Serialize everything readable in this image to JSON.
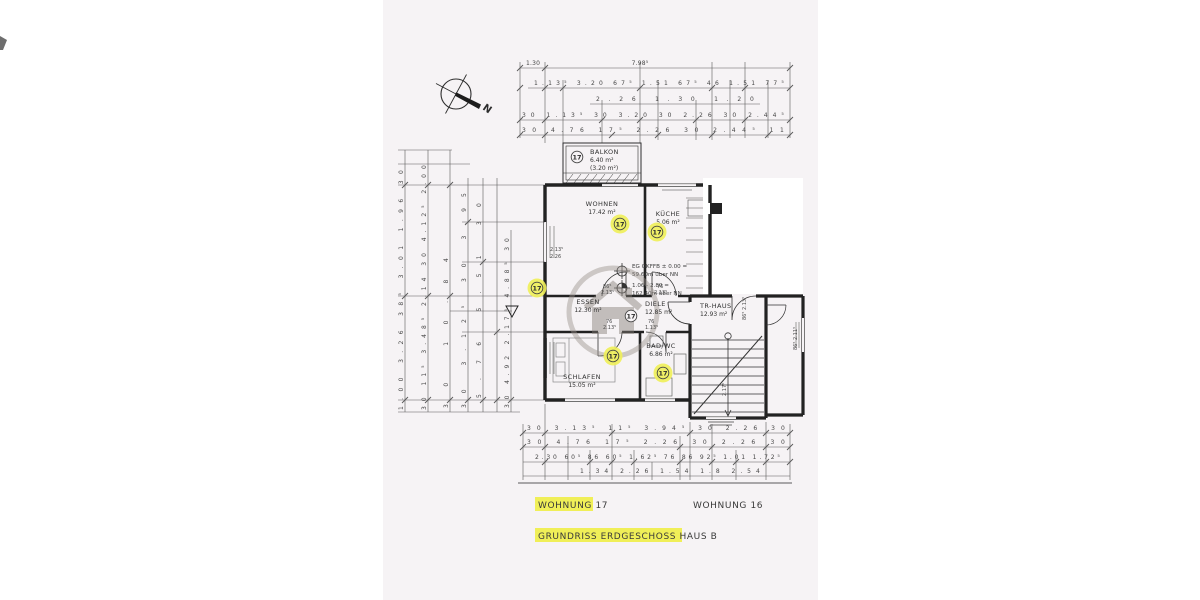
{
  "unit": "17",
  "compass": {
    "label": "N"
  },
  "colors": {
    "paper": "#f6f3f5",
    "highlight": "#f0ef58",
    "ink": "#2e2e2e",
    "watermark": "#857d77"
  },
  "rooms": {
    "balkon": {
      "name": "BALKON",
      "area": "6.40 m²",
      "note": "(3.20 m²)"
    },
    "wohnen": {
      "name": "WOHNEN",
      "area": "17.42 m²"
    },
    "kueche": {
      "name": "KÜCHE",
      "area": "5.06 m²"
    },
    "essen": {
      "name": "ESSEN",
      "area": "12.30 m²"
    },
    "diele": {
      "name": "DIELE",
      "area": "12.85 m²"
    },
    "schlafen": {
      "name": "SCHLAFEN",
      "area": "15.05 m²"
    },
    "bad": {
      "name": "BAD/WC",
      "area": "6.86 m²"
    },
    "trhaus": {
      "name": "TR-HAUS",
      "area": "12.93 m²"
    }
  },
  "levels": {
    "line1": "EG OKFFB ± 0.00 =",
    "line2": "59.60m über NN",
    "line3": "1.06 - 2.80 =",
    "line4": "162.40m über NN"
  },
  "captions": {
    "wohnung17": "WOHNUNG 17",
    "wohnung16": "WOHNUNG 16",
    "grundriss": "GRUNDRISS ERDGESCHOSS HAUS B"
  },
  "tags": {
    "win_left_a": "2.13⁵",
    "win_left_b": "2.26",
    "door_wohnen_a": "86⁵",
    "door_wohnen_b": "2.13⁵",
    "door_kueche_a": "76",
    "door_kueche_b": "2.13⁵",
    "door_schlafen_a": "76",
    "door_schlafen_b": "2.13⁵",
    "door_bad_a": "76",
    "door_bad_b": "1.13⁵",
    "tr_side": "86⁵ 2.13⁵",
    "tr_exit": "2.17⁵",
    "right_wall": "86⁵ 2.11⁵"
  },
  "dims": {
    "top1a": "1.30",
    "top1b": "7.98⁵",
    "top2": [
      "1.13⁵",
      "3.20",
      "67⁵",
      "1.51",
      "67⁵",
      "46",
      "1.51",
      "77⁵"
    ],
    "top3": [
      "2.26",
      "1.30",
      "1.20"
    ],
    "top4": [
      "30",
      "1.13⁵",
      "30",
      "3.20",
      "30",
      "2.26",
      "30",
      "2.44⁵"
    ],
    "top5": [
      "30",
      "4.76",
      "17⁵",
      "2.26",
      "30",
      "2.44⁵",
      "11"
    ],
    "bottom1": [
      "30",
      "3.13⁵",
      "11⁵",
      "3.94⁵",
      "30",
      "2.26",
      "30"
    ],
    "bottom2": [
      "30",
      "4.76",
      "17⁵",
      "2.26",
      "30",
      "2.26",
      "30"
    ],
    "bottom3": [
      "2.30",
      "60⁵",
      "86",
      "60⁵",
      "1.62⁵",
      "76",
      "86",
      "92⁵",
      "1.01",
      "1.72⁵"
    ],
    "bottom4": [
      "1.34",
      "2.26",
      "1.54",
      "1.8",
      "2.54"
    ],
    "left1": [
      "1.00",
      "3.26",
      "38⁵",
      "3.01",
      "1.96",
      "30"
    ],
    "left2": [
      "30",
      "11⁵",
      "3.48⁵",
      "2.14",
      "30",
      "4.12⁵",
      "2.00"
    ],
    "left3": [
      "30",
      "10.84"
    ],
    "left4": [
      "30",
      "3.12⁵",
      "30",
      "3.95"
    ],
    "left5": [
      "5.76",
      "5.51",
      "30"
    ],
    "left6": [
      "30",
      "4.92",
      "2.17⁵",
      "4.88⁵",
      "30"
    ]
  }
}
